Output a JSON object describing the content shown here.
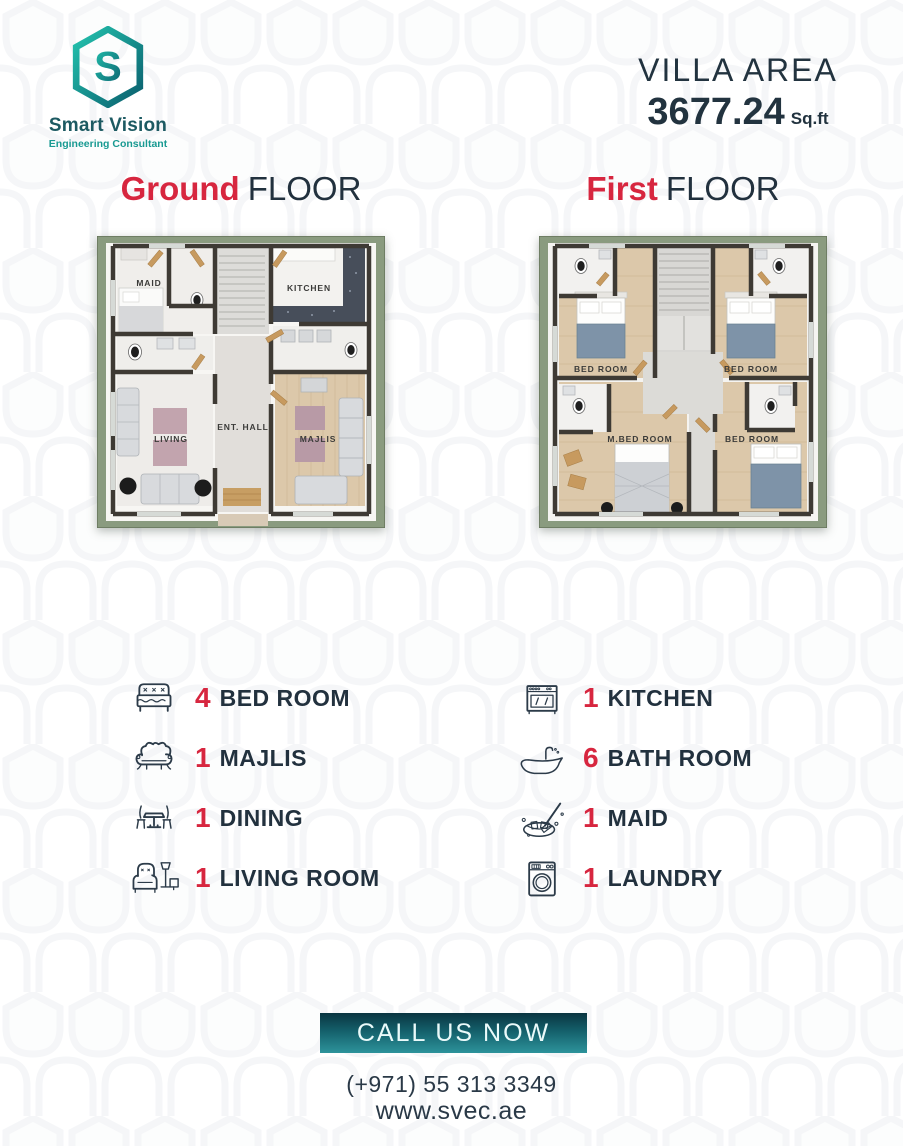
{
  "brand": {
    "name": "Smart Vision",
    "tagline": "Engineering Consultant",
    "logo_letter": "S"
  },
  "header": {
    "area_label": "VILLA AREA",
    "area_value": "3677.24",
    "area_unit": "Sq.ft"
  },
  "floors": {
    "ground": {
      "title_accent": "Ground",
      "title_rest": "FLOOR",
      "rooms": {
        "maid": "MAID",
        "kitchen": "KITCHEN",
        "living": "LIVING",
        "hall": "ENT. HALL",
        "majlis": "MAJLIS"
      }
    },
    "first": {
      "title_accent": "First",
      "title_rest": "FLOOR",
      "rooms": {
        "bed1": "BED ROOM",
        "bed2": "BED ROOM",
        "mbed": "M.BED ROOM",
        "bed3": "BED ROOM"
      }
    }
  },
  "features": {
    "left": [
      {
        "count": "4",
        "label": "BED ROOM",
        "icon": "bed-icon"
      },
      {
        "count": "1",
        "label": "MAJLIS",
        "icon": "sofa-icon"
      },
      {
        "count": "1",
        "label": "DINING",
        "icon": "dining-table-icon"
      },
      {
        "count": "1",
        "label": "LIVING ROOM",
        "icon": "armchair-icon"
      }
    ],
    "right": [
      {
        "count": "1",
        "label": "KITCHEN",
        "icon": "stove-icon"
      },
      {
        "count": "6",
        "label": "BATH ROOM",
        "icon": "bathtub-icon"
      },
      {
        "count": "1",
        "label": "MAID",
        "icon": "cleaning-icon"
      },
      {
        "count": "1",
        "label": "LAUNDRY",
        "icon": "washing-machine-icon"
      }
    ]
  },
  "footer": {
    "cta": "CALL US NOW",
    "phone": "(+971) 55 313 3349",
    "website": "www.svec.ae"
  },
  "colors": {
    "accent_red": "#d7263f",
    "dark_navy": "#22313e",
    "brand_teal": "#199a92",
    "button_gradient_top": "#0a3541",
    "button_gradient_bottom": "#2d939b",
    "plan_frame_green": "#8a9b7f"
  }
}
